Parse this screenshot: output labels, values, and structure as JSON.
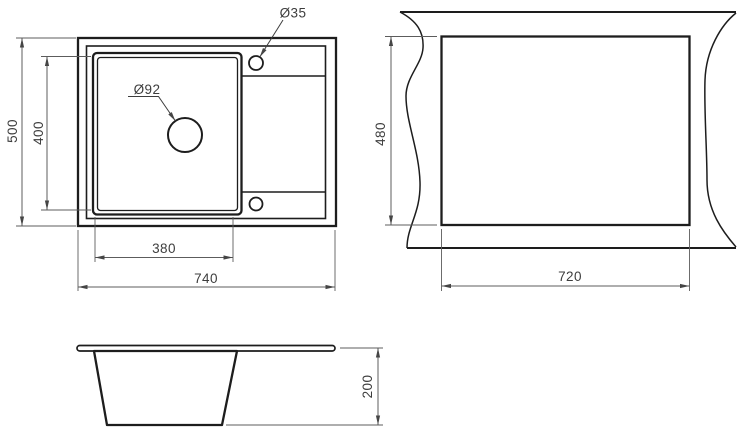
{
  "drawing": {
    "type": "kitchen-sink-installation-drawing",
    "background": "#ffffff",
    "line_color": "#1d1d1d",
    "dimension_color": "#5c5c5c",
    "text_color": "#3d3d3d",
    "top_view": {
      "overall_width": "740",
      "overall_depth": "500",
      "bowl_width": "380",
      "bowl_depth": "400",
      "drain_hole_label": "Ø92",
      "tap_hole_label": "Ø35"
    },
    "cutout_view": {
      "cutout_width": "720",
      "cutout_depth": "480"
    },
    "side_view": {
      "bowl_height": "200"
    }
  }
}
